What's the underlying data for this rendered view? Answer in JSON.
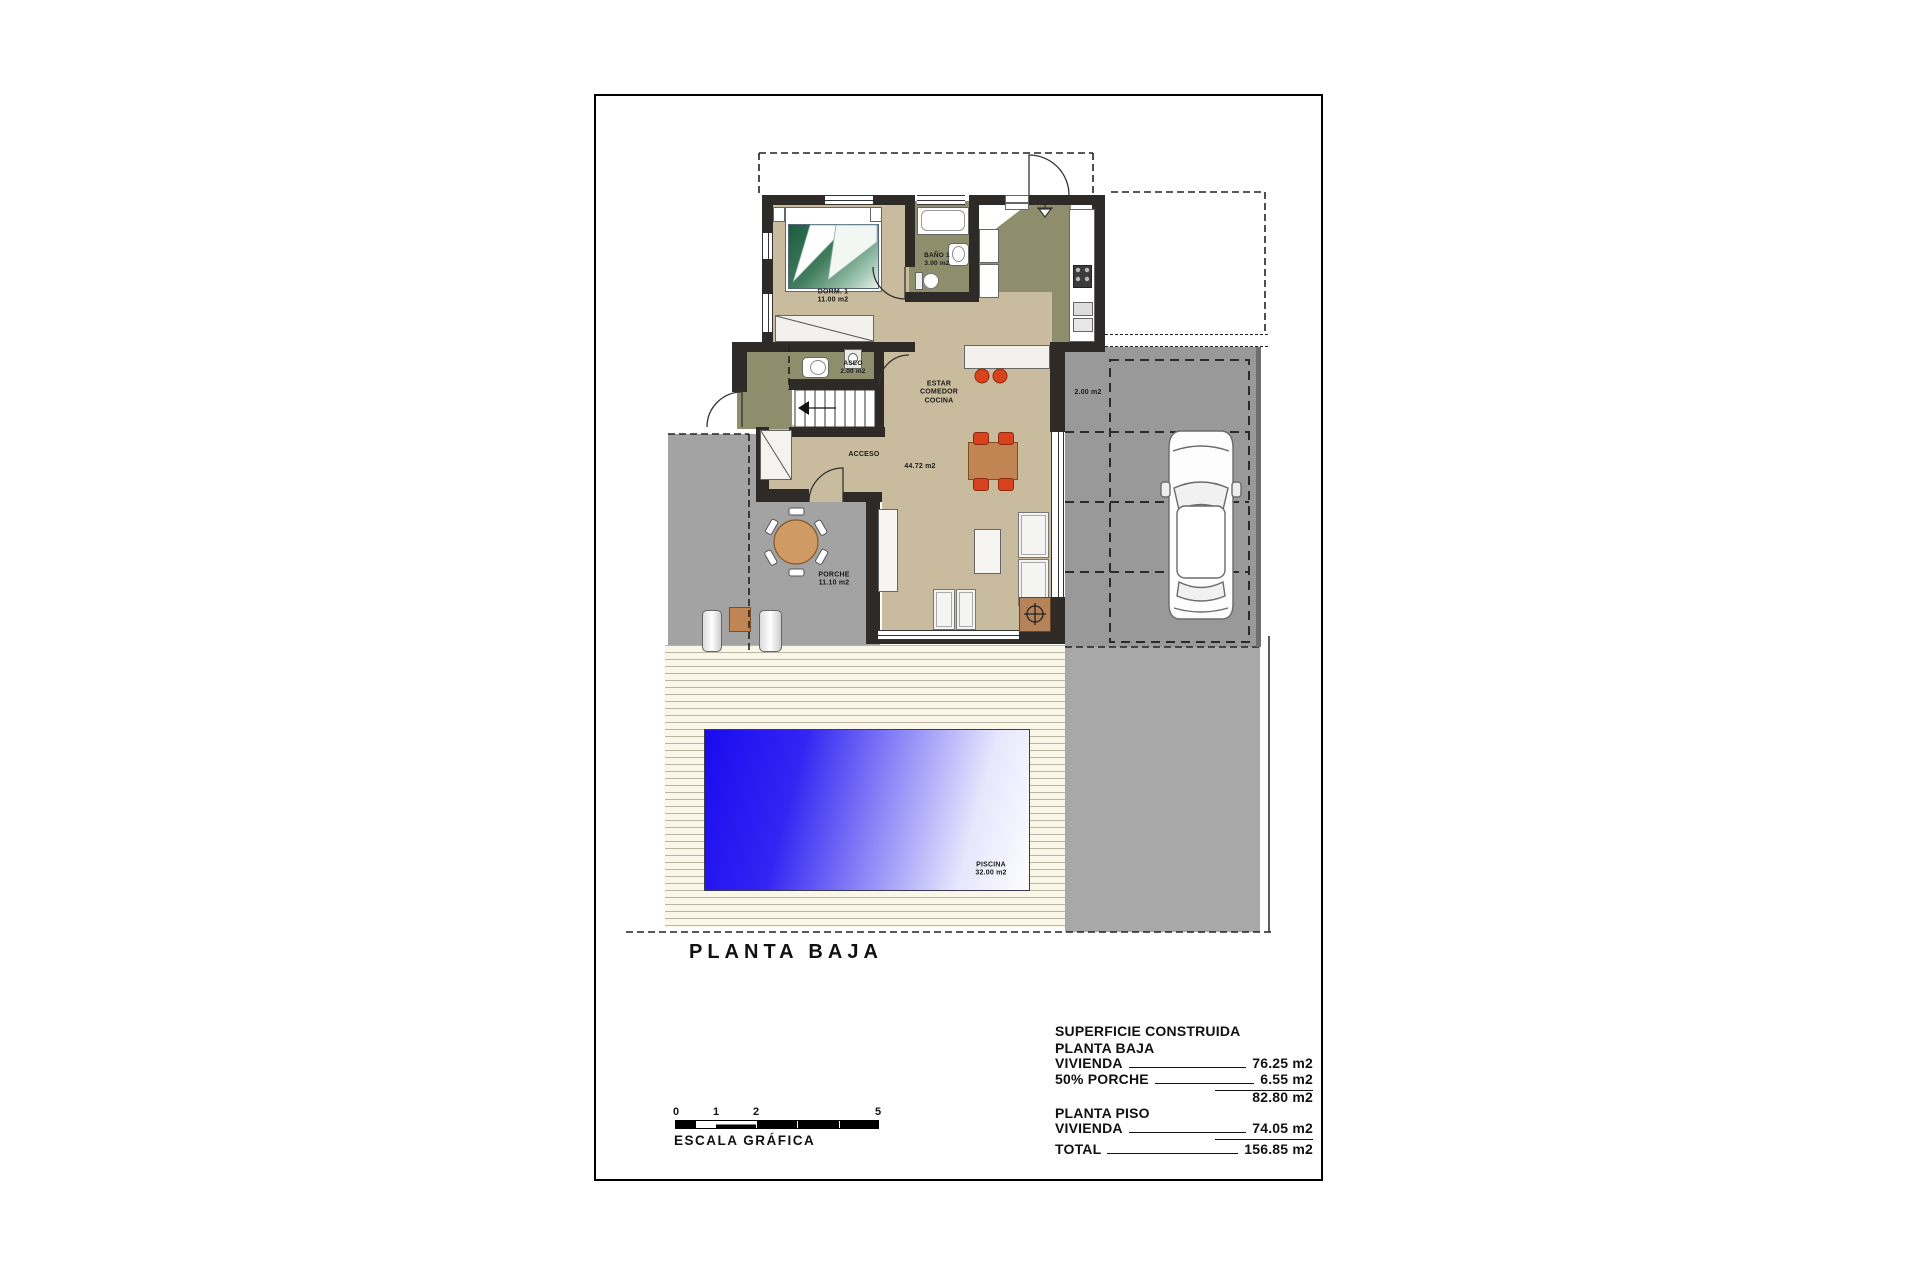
{
  "page": {
    "title": "PLANTA BAJA"
  },
  "rooms": {
    "dorm": {
      "name": "DORM. 1",
      "area": "11.00 m2"
    },
    "bano": {
      "name": "BAÑO 1",
      "area": "3.00 m2"
    },
    "aseo": {
      "name": "ASEO",
      "area": "2.00 m2"
    },
    "estar": {
      "lines": [
        "ESTAR",
        "COMEDOR",
        "COCINA"
      ],
      "area": "44.72 m2"
    },
    "acceso": {
      "name": "ACCESO"
    },
    "porche": {
      "name": "PORCHE",
      "area": "11.10 m2"
    },
    "piscina": {
      "name": "PISCINA",
      "area": "32.00 m2"
    },
    "parking": {
      "area": "2.00 m2"
    }
  },
  "scale_bar": {
    "ticks": [
      "0",
      "1",
      "2",
      "5"
    ],
    "label": "ESCALA GRÁFICA"
  },
  "summary": {
    "header": "SUPERFICIE CONSTRUIDA",
    "sections": [
      {
        "title": "PLANTA BAJA",
        "rows": [
          {
            "label": "VIVIENDA",
            "value": "76.25 m2"
          },
          {
            "label": "50% PORCHE",
            "value": "6.55 m2"
          }
        ],
        "subtotal": "82.80 m2"
      },
      {
        "title": "PLANTA PISO",
        "rows": [
          {
            "label": "VIVIENDA",
            "value": "74.05 m2"
          }
        ]
      }
    ],
    "total_label": "TOTAL",
    "total_value": "156.85 m2"
  },
  "colors": {
    "wall": "#2d2a27",
    "floor_tan": "#c9bb9d",
    "kitchen_olive": "#8e8e6c",
    "porch_gray": "#a3a3a3",
    "garage_gray": "#999999",
    "deck_cream": "#faf6e8",
    "pool_blue": "#1a0bf0",
    "chair_red": "#d8431d",
    "wood_brown": "#c08552"
  }
}
